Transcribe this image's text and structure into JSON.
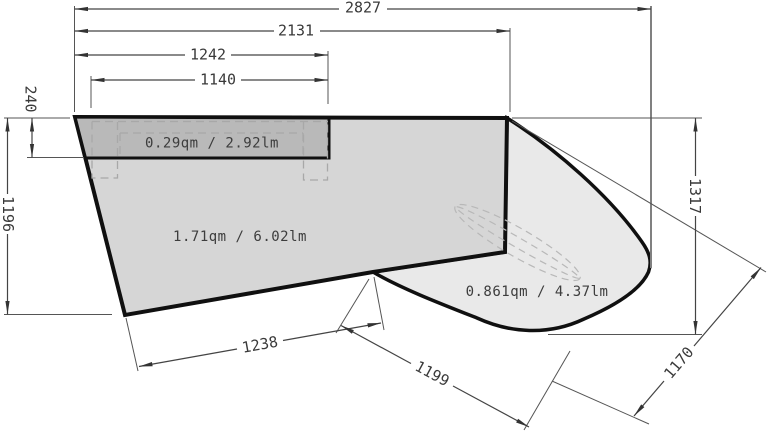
{
  "drawing": {
    "type": "cad-dimension-plan",
    "areas": {
      "worktop_strip": {
        "label": "0.29qm / 2.92lm"
      },
      "main_panel": {
        "label": "1.71qm / 6.02lm"
      },
      "curved_panel": {
        "label": "0.861qm / 4.37lm"
      }
    },
    "dimensions": {
      "d2827": "2827",
      "d2131": "2131",
      "d1242": "1242",
      "d1140": "1140",
      "d240": "240",
      "d1196": "1196",
      "d1317": "1317",
      "d1238": "1238",
      "d1199": "1199",
      "d1170": "1170"
    },
    "colors": {
      "background": "#ffffff",
      "main_fill": "#d6d6d6",
      "strip_fill": "#b9b9b9",
      "curved_fill": "#e9e9e9",
      "outline": "#101010",
      "dim_line": "#444444",
      "dashed_line": "#a8a8a8",
      "text": "#3a3a3a"
    }
  }
}
